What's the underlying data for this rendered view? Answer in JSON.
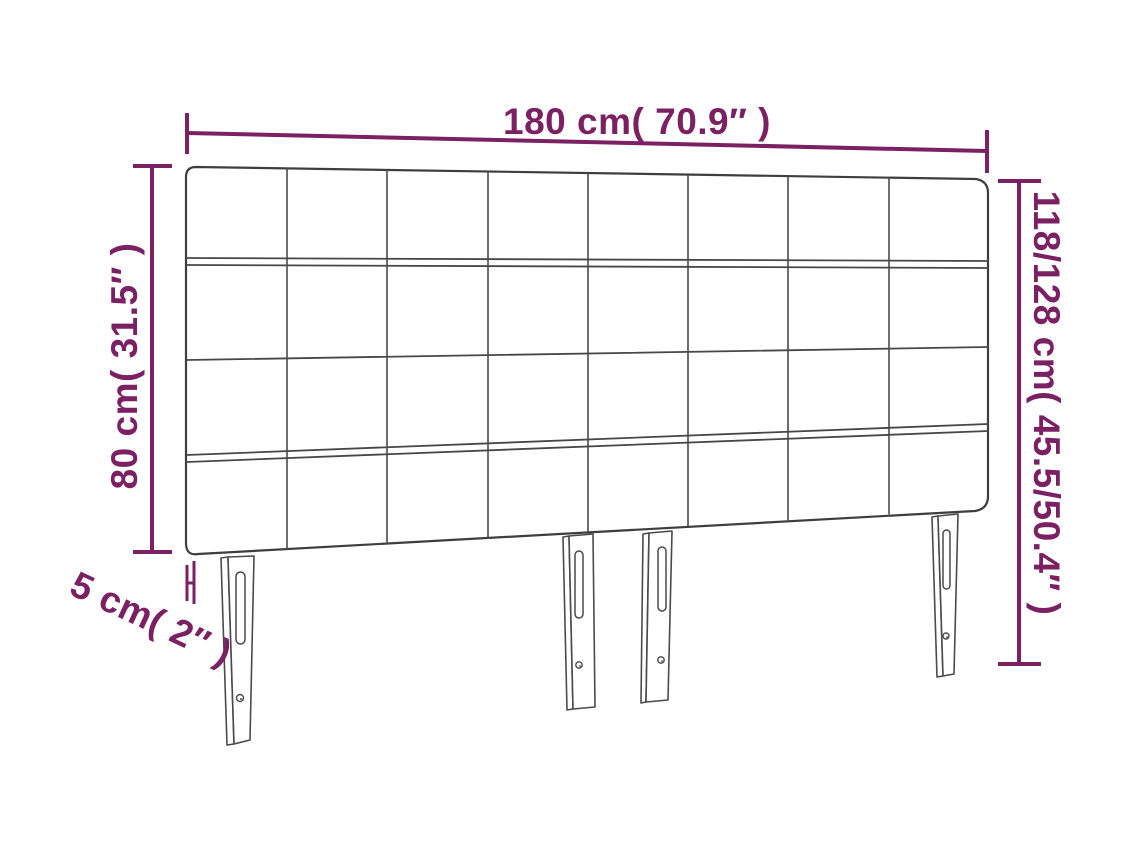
{
  "diagram": {
    "colors": {
      "dimension_accent": "#7b2062",
      "drawing_outline": "#4a4a4a",
      "background": "#ffffff"
    },
    "labels": {
      "width": "180 cm( 70.9″ )",
      "panel_height": "80 cm( 31.5″ )",
      "total_height": "118/128 cm( 45.5/50.4″ )",
      "thickness": "5 cm( 2″ )"
    },
    "structure": {
      "grid_columns": 8,
      "grid_rows": 4,
      "legs": 4
    }
  }
}
